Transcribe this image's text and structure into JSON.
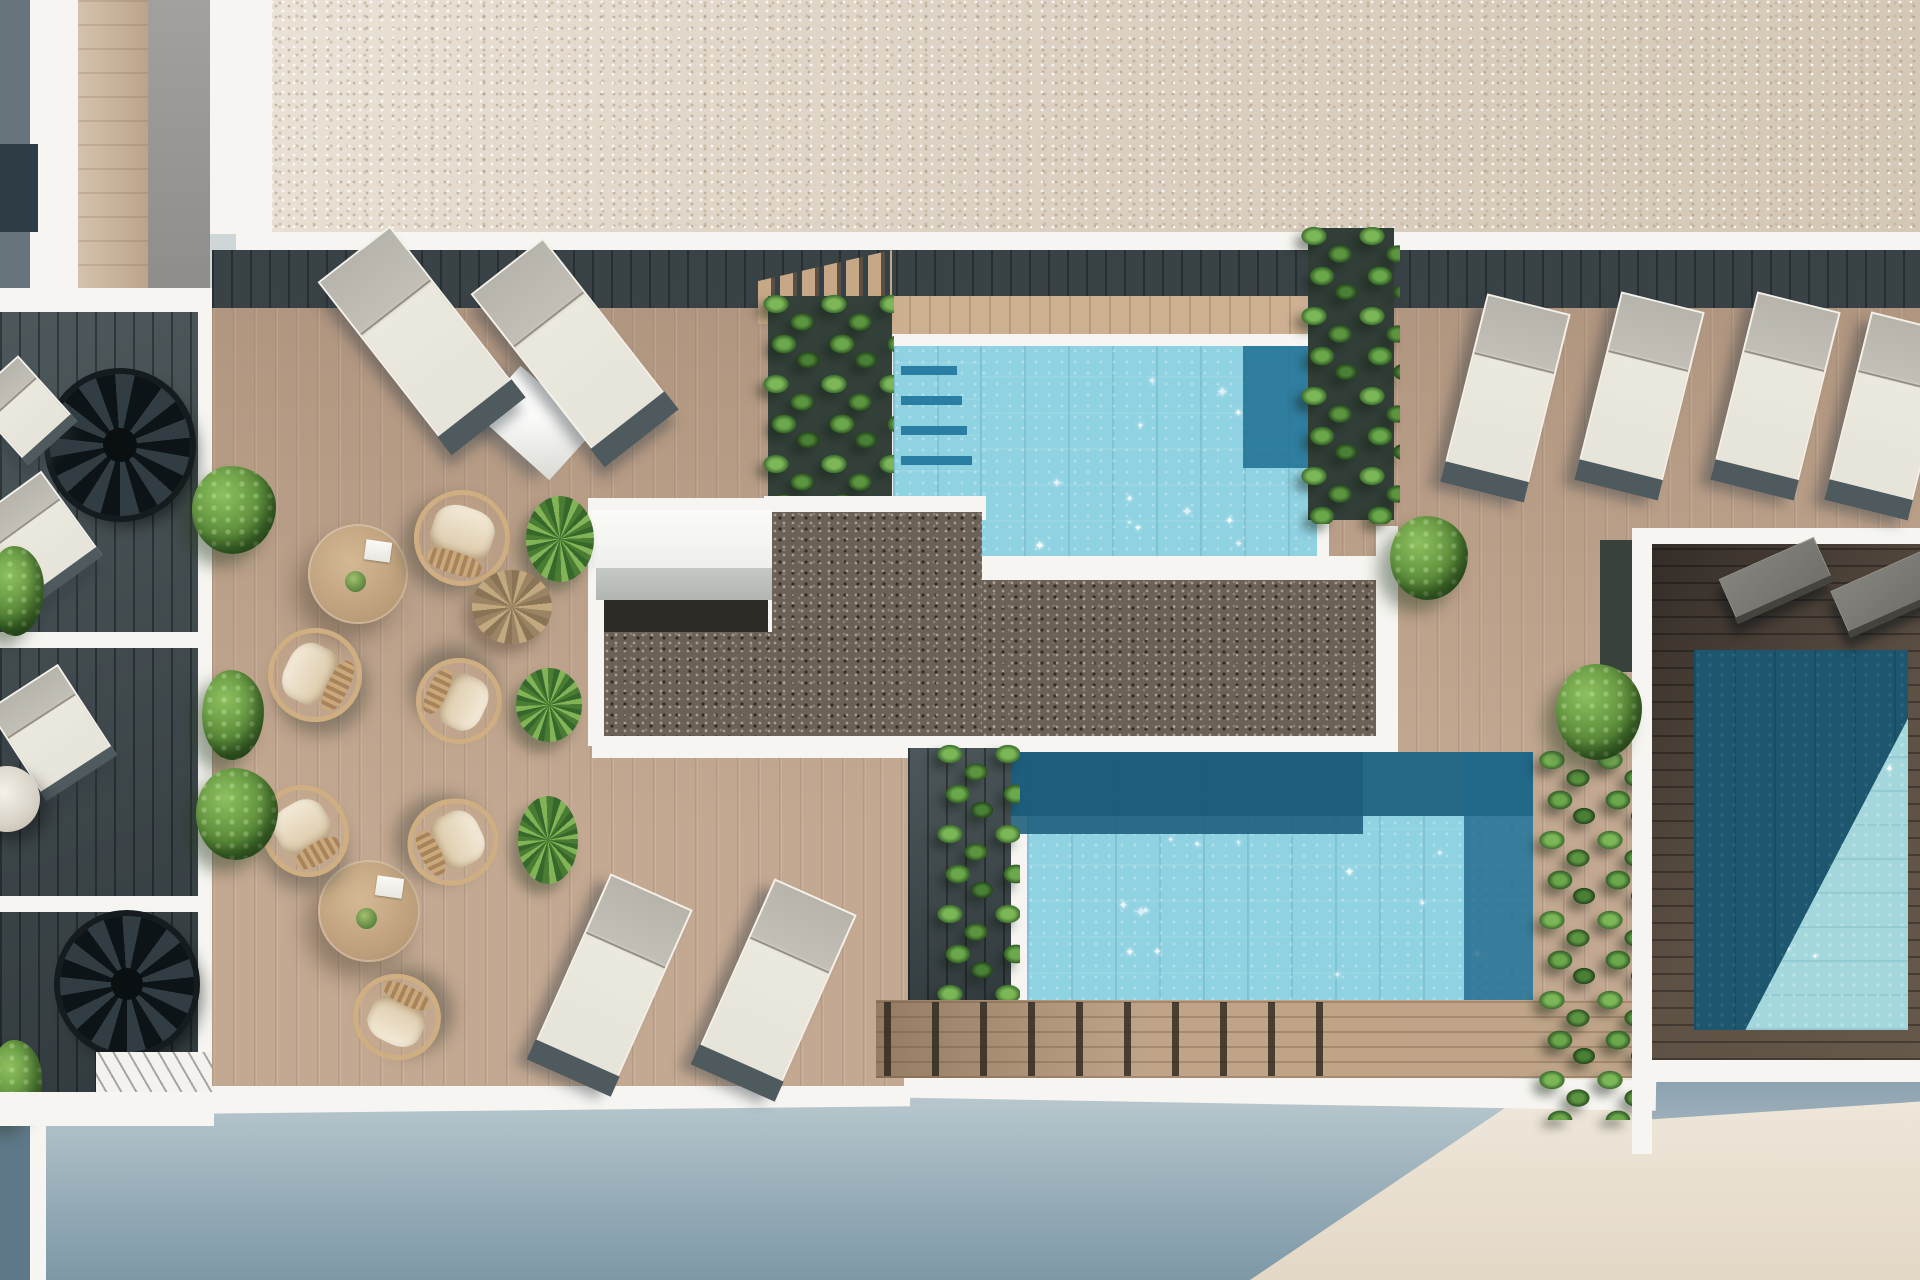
{
  "meta": {
    "scene": "aerial-render-rooftop-pool-terrace",
    "canvas": {
      "w": 1920,
      "h": 1280
    }
  },
  "palette": {
    "roof_gravel": "#d9cec0",
    "white_wall": "#f6f5f1",
    "deck_wood": "#bda088",
    "deck_shadow": "#2c3a40",
    "dark_gravel": "#6b6157",
    "pool_light": "#8fd2e2",
    "pool_dark": "#1c607f",
    "pool3_dark": "#1d566f",
    "plant_green": "#4a8035",
    "ground_shade": "#93aab6",
    "facade_sun": "#efe9dd"
  },
  "objects": [
    {
      "n": "ground-shadow",
      "t": "ground",
      "x": 0,
      "y": 1040,
      "w": 1920,
      "h": 240
    },
    {
      "n": "facade-sunlit",
      "t": "sunwedge",
      "x": 1250,
      "y": 1072,
      "w": 670,
      "h": 208
    },
    {
      "n": "facade-shade-strip",
      "t": "shadestrip",
      "x": 1642,
      "y": 1076,
      "w": 278,
      "h": 44
    },
    {
      "n": "bottom-wall-left",
      "t": "wall",
      "x": 196,
      "y": 1080,
      "w": 714,
      "h": 30,
      "r": -0.6
    },
    {
      "n": "bottom-wall-center",
      "t": "wall",
      "x": 876,
      "y": 1074,
      "w": 780,
      "h": 30,
      "r": 1
    },
    {
      "n": "bottom-wall-right",
      "t": "wall",
      "x": 1642,
      "y": 1056,
      "w": 278,
      "h": 26
    },
    {
      "n": "building-corner-edge",
      "t": "wall",
      "x": 30,
      "y": 1096,
      "w": 16,
      "h": 184
    },
    {
      "n": "building-corner-dark",
      "t": "rect",
      "c": "#5f7889",
      "x": 0,
      "y": 1096,
      "w": 30,
      "h": 184
    },
    {
      "n": "roof-gravel",
      "t": "gravel-light",
      "x": 270,
      "y": 0,
      "w": 1650,
      "h": 234
    },
    {
      "n": "roof-walk-band",
      "t": "wall",
      "x": 236,
      "y": 232,
      "w": 1684,
      "h": 22
    },
    {
      "n": "bld-col-dark",
      "t": "rect",
      "c": "#68747b",
      "x": 0,
      "y": 0,
      "w": 30,
      "h": 290
    },
    {
      "n": "bld-col-white",
      "t": "wall",
      "x": 30,
      "y": 0,
      "w": 48,
      "h": 290
    },
    {
      "n": "bld-col-wood",
      "t": "wood-v",
      "x": 78,
      "y": 0,
      "w": 70,
      "h": 290
    },
    {
      "n": "bld-col-gray",
      "t": "rect",
      "c": "linear-gradient(180deg,#a3a19d,#8f8d89)",
      "x": 148,
      "y": 0,
      "w": 62,
      "h": 290
    },
    {
      "n": "bld-col-white-2",
      "t": "wall",
      "x": 210,
      "y": 0,
      "w": 62,
      "h": 234
    },
    {
      "n": "bld-window",
      "t": "rect",
      "c": "#2e3d45",
      "x": 0,
      "y": 144,
      "w": 38,
      "h": 88
    },
    {
      "n": "left-walk-band",
      "t": "wall",
      "x": 0,
      "y": 288,
      "w": 212,
      "h": 26
    },
    {
      "n": "left-terrace-deck",
      "t": "deck-dark",
      "x": 0,
      "y": 312,
      "w": 212,
      "h": 786
    },
    {
      "n": "left-divider-1",
      "t": "wall",
      "x": 0,
      "y": 632,
      "w": 212,
      "h": 16
    },
    {
      "n": "left-divider-2",
      "t": "wall",
      "x": 0,
      "y": 896,
      "w": 212,
      "h": 16
    },
    {
      "n": "left-wall-inner",
      "t": "wall",
      "x": 198,
      "y": 312,
      "w": 14,
      "h": 772
    },
    {
      "n": "spiral-stair-upper",
      "t": "spiral",
      "x": 50,
      "y": 374,
      "w": 140,
      "h": 142
    },
    {
      "n": "spiral-stair-lower",
      "t": "spiral",
      "x": 60,
      "y": 916,
      "w": 134,
      "h": 136
    },
    {
      "n": "left-lounger-top",
      "t": "lounger",
      "x": -10,
      "y": 366,
      "w": 66,
      "h": 88,
      "r": -42
    },
    {
      "n": "left-lounger-mid",
      "t": "lounger",
      "x": -6,
      "y": 486,
      "w": 86,
      "h": 104,
      "r": -36
    },
    {
      "n": "left-lounger-low",
      "t": "lounger",
      "x": 10,
      "y": 678,
      "w": 84,
      "h": 108,
      "r": -33
    },
    {
      "n": "left-bush-top",
      "t": "bush",
      "x": -12,
      "y": 546,
      "w": 56,
      "h": 90
    },
    {
      "n": "left-umbrella",
      "t": "umbrella",
      "x": -26,
      "y": 766,
      "w": 66,
      "h": 66
    },
    {
      "n": "left-bush-bottom",
      "t": "bush",
      "x": -10,
      "y": 1040,
      "w": 52,
      "h": 84
    },
    {
      "n": "left-hatch-walkway",
      "t": "hatch",
      "x": 96,
      "y": 1052,
      "w": 118,
      "h": 50
    },
    {
      "n": "left-bottom-wall",
      "t": "wall",
      "x": 0,
      "y": 1092,
      "w": 214,
      "h": 34
    },
    {
      "n": "deck-left",
      "t": "deck",
      "x": 212,
      "y": 250,
      "w": 692,
      "h": 836
    },
    {
      "n": "deck-center",
      "t": "deck",
      "x": 880,
      "y": 250,
      "w": 530,
      "h": 760
    },
    {
      "n": "deck-right",
      "t": "deck",
      "x": 1374,
      "y": 250,
      "w": 546,
      "h": 782
    },
    {
      "n": "deck-shadow-band",
      "t": "deck-shadow",
      "x": 212,
      "y": 250,
      "w": 1708,
      "h": 58
    },
    {
      "n": "deck-stairs-top",
      "t": "stairs",
      "x": 758,
      "y": 250,
      "w": 134,
      "h": 74
    },
    {
      "n": "pool1-sun-strip",
      "t": "wood-sun",
      "x": 889,
      "y": 296,
      "w": 492,
      "h": 42
    },
    {
      "n": "pool1-rim",
      "t": "wall",
      "x": 881,
      "y": 334,
      "w": 448,
      "h": 248
    },
    {
      "n": "pool1-water-left",
      "t": "water",
      "x": 893,
      "y": 346,
      "w": 424,
      "h": 162,
      "sp": 8
    },
    {
      "n": "pool1-water-main",
      "t": "water",
      "x": 980,
      "y": 346,
      "w": 337,
      "h": 212,
      "sp": 12
    },
    {
      "n": "pool1-step-1",
      "t": "rect",
      "c": "#2a7ea4",
      "x": 901,
      "y": 366,
      "w": 56,
      "h": 9
    },
    {
      "n": "pool1-step-2",
      "t": "rect",
      "c": "#2a7ea4",
      "x": 901,
      "y": 396,
      "w": 61,
      "h": 9
    },
    {
      "n": "pool1-step-3",
      "t": "rect",
      "c": "#2a7ea4",
      "x": 901,
      "y": 426,
      "w": 66,
      "h": 9
    },
    {
      "n": "pool1-step-4",
      "t": "rect",
      "c": "#2a7ea4",
      "x": 901,
      "y": 456,
      "w": 71,
      "h": 9
    },
    {
      "n": "pool1-dark-corner",
      "t": "rect",
      "c": "#1f6e93",
      "o": 0.85,
      "x": 1243,
      "y": 346,
      "w": 74,
      "h": 122
    },
    {
      "n": "pool1-planter-shadow",
      "t": "rect",
      "c": "#33413a",
      "x": 768,
      "y": 296,
      "w": 124,
      "h": 284
    },
    {
      "n": "pool1-plants",
      "t": "vines",
      "x": 762,
      "y": 292,
      "w": 132,
      "h": 292
    },
    {
      "n": "skylight-slab",
      "t": "slab",
      "x": 486,
      "y": 390,
      "w": 98,
      "h": 66,
      "r": 42
    },
    {
      "n": "gravel-plate-left",
      "t": "wall",
      "x": 588,
      "y": 498,
      "w": 206,
      "h": 248
    },
    {
      "n": "gravel-plate-top",
      "t": "wall",
      "x": 764,
      "y": 496,
      "w": 222,
      "h": 24
    },
    {
      "n": "gravel-plate-step",
      "t": "wall",
      "x": 976,
      "y": 556,
      "w": 410,
      "h": 26
    },
    {
      "n": "gravel-plate-bottom",
      "t": "wall",
      "x": 592,
      "y": 734,
      "w": 804,
      "h": 24
    },
    {
      "n": "skylight-box-top",
      "t": "rect",
      "c": "linear-gradient(180deg,#fafaf7,#eff0ed)",
      "x": 592,
      "y": 510,
      "w": 180,
      "h": 58
    },
    {
      "n": "skylight-box-side",
      "t": "rect",
      "c": "linear-gradient(180deg,#c5c9c6,#b2b6b3)",
      "x": 596,
      "y": 568,
      "w": 176,
      "h": 32
    },
    {
      "n": "skylight-cast-shadow",
      "t": "rect",
      "c": "#2e2a25",
      "x": 604,
      "y": 600,
      "w": 164,
      "h": 32
    },
    {
      "n": "gravel-ext",
      "t": "gravel-dark",
      "x": 604,
      "y": 632,
      "w": 168,
      "h": 104
    },
    {
      "n": "gravel-left",
      "t": "gravel-dark",
      "x": 772,
      "y": 512,
      "w": 210,
      "h": 224
    },
    {
      "n": "gravel-main",
      "t": "gravel-dark",
      "x": 982,
      "y": 580,
      "w": 394,
      "h": 156
    },
    {
      "n": "gravel-right-wall",
      "t": "wall",
      "x": 1376,
      "y": 526,
      "w": 22,
      "h": 226
    },
    {
      "n": "planter2-shadow",
      "t": "rect",
      "c": "#313f38",
      "x": 1308,
      "y": 228,
      "w": 86,
      "h": 292
    },
    {
      "n": "pool1-plants-right",
      "t": "vines",
      "x": 1300,
      "y": 224,
      "w": 100,
      "h": 300
    },
    {
      "n": "pool2-stair-strip",
      "t": "deck-dark",
      "x": 908,
      "y": 748,
      "w": 106,
      "h": 258
    },
    {
      "n": "pool2-rim-left",
      "t": "wall",
      "x": 1011,
      "y": 752,
      "w": 16,
      "h": 258
    },
    {
      "n": "pool2-water",
      "t": "water",
      "x": 1027,
      "y": 752,
      "w": 506,
      "h": 258,
      "sp": 14
    },
    {
      "n": "pool2-shade-top",
      "t": "rect",
      "c": "#1c607f",
      "o": 0.92,
      "x": 1011,
      "y": 752,
      "w": 522,
      "h": 64
    },
    {
      "n": "pool2-shade-left",
      "t": "rect",
      "c": "#1b5c7b",
      "o": 0.88,
      "x": 1011,
      "y": 752,
      "w": 352,
      "h": 82
    },
    {
      "n": "pool2-shade-right",
      "t": "rect",
      "c": "#20688a",
      "o": 0.8,
      "x": 1464,
      "y": 752,
      "w": 69,
      "h": 258
    },
    {
      "n": "pool2-plants-left",
      "t": "vines",
      "x": 936,
      "y": 742,
      "w": 84,
      "h": 290
    },
    {
      "n": "boardwalk",
      "t": "boardwalk",
      "x": 876,
      "y": 1000,
      "w": 776,
      "h": 78
    },
    {
      "n": "boardwalk-posts",
      "t": "posts",
      "x": 884,
      "y": 1002,
      "w": 470,
      "h": 74
    },
    {
      "n": "pool2-plants-right",
      "t": "vines",
      "x": 1538,
      "y": 748,
      "w": 108,
      "h": 372
    },
    {
      "n": "hedge-shadow-right",
      "t": "rect",
      "c": "#39413c",
      "x": 1600,
      "y": 540,
      "w": 34,
      "h": 132
    },
    {
      "n": "right-terrace-wall-left",
      "t": "wall",
      "x": 1632,
      "y": 528,
      "w": 20,
      "h": 626
    },
    {
      "n": "right-terrace-wall-top",
      "t": "wall",
      "x": 1642,
      "y": 528,
      "w": 278,
      "h": 16
    },
    {
      "n": "right-terrace-deck",
      "t": "terrace-dark",
      "x": 1652,
      "y": 544,
      "w": 268,
      "h": 516
    },
    {
      "n": "pool3-water-dark",
      "t": "water-dark",
      "x": 1694,
      "y": 650,
      "w": 214,
      "h": 380
    },
    {
      "n": "pool3-water-light",
      "t": "pool3light",
      "x": 1694,
      "y": 650,
      "w": 214,
      "h": 380,
      "sp": 10
    },
    {
      "n": "gray-lounger-1",
      "t": "lounger-dark",
      "x": 1724,
      "y": 556,
      "w": 104,
      "h": 48,
      "r": -24
    },
    {
      "n": "gray-lounger-2",
      "t": "lounger-dark",
      "x": 1836,
      "y": 568,
      "w": 104,
      "h": 50,
      "r": -24
    },
    {
      "n": "lounger-right-1",
      "t": "lounger",
      "x": 1463,
      "y": 301,
      "w": 86,
      "h": 190,
      "r": 14
    },
    {
      "n": "lounger-right-2",
      "t": "lounger",
      "x": 1597,
      "y": 299,
      "w": 86,
      "h": 190,
      "r": 14
    },
    {
      "n": "lounger-right-3",
      "t": "lounger",
      "x": 1733,
      "y": 299,
      "w": 86,
      "h": 190,
      "r": 14
    },
    {
      "n": "lounger-right-4",
      "t": "lounger",
      "x": 1847,
      "y": 319,
      "w": 86,
      "h": 190,
      "r": 14
    },
    {
      "n": "lounger-topleft-1",
      "t": "lounger",
      "x": 374,
      "y": 231,
      "w": 92,
      "h": 215,
      "r": -38
    },
    {
      "n": "lounger-topleft-2",
      "t": "lounger",
      "x": 527,
      "y": 243,
      "w": 92,
      "h": 215,
      "r": -38
    },
    {
      "n": "lounger-bottom-1",
      "t": "lounger",
      "x": 566,
      "y": 883,
      "w": 90,
      "h": 200,
      "r": 24
    },
    {
      "n": "lounger-bottom-2",
      "t": "lounger",
      "x": 730,
      "y": 888,
      "w": 90,
      "h": 200,
      "r": 24
    },
    {
      "n": "table-upper",
      "t": "table",
      "x": 308,
      "y": 524,
      "w": 100,
      "h": 100
    },
    {
      "n": "table-lower",
      "t": "table",
      "x": 318,
      "y": 860,
      "w": 102,
      "h": 102
    },
    {
      "n": "chair-upper-1",
      "t": "chair",
      "x": 414,
      "y": 490,
      "w": 96,
      "h": 96,
      "r": 18
    },
    {
      "n": "chair-upper-2",
      "t": "chair",
      "x": 268,
      "y": 628,
      "w": 94,
      "h": 94,
      "r": -64
    },
    {
      "n": "chair-upper-3",
      "t": "chair",
      "x": 416,
      "y": 658,
      "w": 86,
      "h": 86,
      "r": 115
    },
    {
      "n": "chair-lower-1",
      "t": "chair",
      "x": 262,
      "y": 784,
      "w": 86,
      "h": 94,
      "r": -30
    },
    {
      "n": "chair-lower-2",
      "t": "chair",
      "x": 410,
      "y": 796,
      "w": 86,
      "h": 92,
      "r": 64
    },
    {
      "n": "chair-lower-3",
      "t": "chair",
      "x": 353,
      "y": 974,
      "w": 88,
      "h": 86,
      "r": -155
    },
    {
      "n": "bush-deck-1",
      "t": "bush",
      "x": 192,
      "y": 466,
      "w": 84,
      "h": 88
    },
    {
      "n": "bush-deck-2",
      "t": "bush",
      "x": 202,
      "y": 670,
      "w": 62,
      "h": 90
    },
    {
      "n": "bush-deck-3",
      "t": "bush",
      "x": 196,
      "y": 768,
      "w": 82,
      "h": 92
    },
    {
      "n": "yucca-1",
      "t": "yucca",
      "x": 526,
      "y": 496,
      "w": 68,
      "h": 86
    },
    {
      "n": "palm-dry",
      "t": "palmdry",
      "x": 472,
      "y": 570,
      "w": 80,
      "h": 74
    },
    {
      "n": "yucca-2",
      "t": "yucca",
      "x": 516,
      "y": 668,
      "w": 66,
      "h": 74
    },
    {
      "n": "yucca-3",
      "t": "yucca",
      "x": 518,
      "y": 796,
      "w": 60,
      "h": 88
    },
    {
      "n": "bush-right-1",
      "t": "bush",
      "x": 1390,
      "y": 516,
      "w": 78,
      "h": 84
    },
    {
      "n": "bush-right-2",
      "t": "bush",
      "x": 1556,
      "y": 664,
      "w": 86,
      "h": 96
    }
  ]
}
